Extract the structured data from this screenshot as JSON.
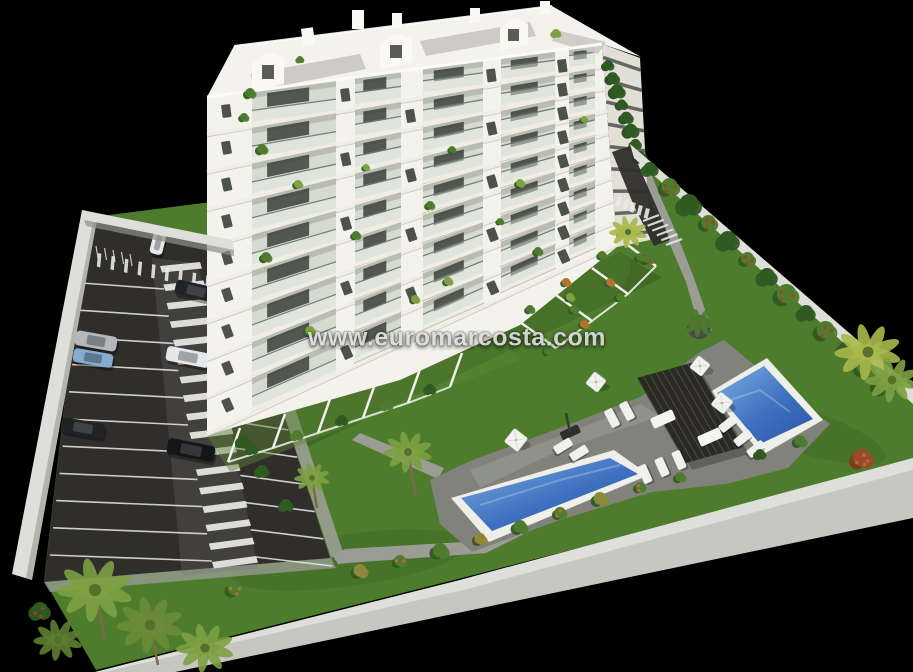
{
  "watermark": {
    "text": "www.euromarcosta.com"
  },
  "scene": {
    "type": "3d-architectural-render",
    "building_floors": 9,
    "pools": 2,
    "pergolas": 1,
    "parked_cars": 8,
    "sun_umbrellas": 4
  },
  "colors": {
    "bg": "#000000",
    "bldg": "#f4f2ec",
    "bldgBright": "#faf8f3",
    "bldgShade": "#e2dfd6",
    "slab": "#f0ede4",
    "balc": "#d6dacf",
    "windowDark": "#3b403b",
    "railDark": "#454a44",
    "roofDeck": "#c9c7bf",
    "grass": "#4e7c2d",
    "grassDark": "#39641f",
    "path": "#9b9d95",
    "deck": "#80827b",
    "asphalt": "#302e2b",
    "asphaltLane": "#454340",
    "line": "#e9e9e5",
    "coping": "#edefe8",
    "poolDeep": "#2a55a8",
    "poolLight": "#7db0e0",
    "pergola": "#26261f",
    "wall": "#c6c7c0",
    "wallLight": "#dededa",
    "bush": "#4e7c2f",
    "bushDark": "#2f5a22",
    "palm": "#7da043",
    "palmYellow": "#a9b84a",
    "flowerRed": "#b03a28",
    "flowerOrange": "#b5722f",
    "carWhite": "#e5e8ea",
    "carSilver": "#b4b8bc",
    "carBlue": "#85accf",
    "carDark": "#212426",
    "carDark2": "#141619",
    "watermark": "#dcdcdc"
  }
}
